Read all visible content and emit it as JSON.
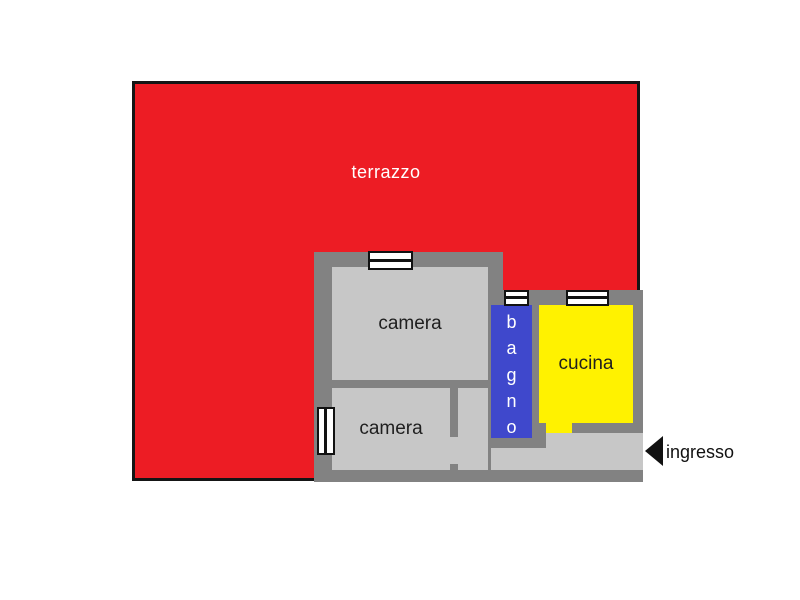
{
  "plan": {
    "terrace": {
      "label": "terrazzo",
      "color": "#ed1c24",
      "text_color": "#ffffff"
    },
    "rooms": [
      {
        "id": "camera-1",
        "label": "camera",
        "color": "#c7c7c7",
        "text_color": "#1f1f1f"
      },
      {
        "id": "camera-2",
        "label": "camera",
        "color": "#c7c7c7",
        "text_color": "#1f1f1f"
      },
      {
        "id": "bagno",
        "label": "bagno",
        "letters": [
          "b",
          "a",
          "g",
          "n",
          "o"
        ],
        "color": "#3f48cc",
        "text_color": "#ffffff"
      },
      {
        "id": "cucina",
        "label": "cucina",
        "color": "#fff200",
        "text_color": "#1f1f1f"
      }
    ],
    "entrance": {
      "label": "ingresso",
      "direction": "left",
      "arrow_color": "#111111",
      "text_color": "#111111"
    },
    "windows": [
      {
        "id": "window-camera-1-top",
        "orientation": "horizontal"
      },
      {
        "id": "window-bagno-top",
        "orientation": "horizontal"
      },
      {
        "id": "window-cucina-top",
        "orientation": "horizontal"
      },
      {
        "id": "window-camera-2-left",
        "orientation": "vertical"
      }
    ],
    "colors": {
      "wall": "#828282",
      "room_floor": "#c7c7c7",
      "corridor_floor": "#c7c7c7",
      "window": "#ffffff",
      "outline": "#151515",
      "background": "#ffffff"
    }
  }
}
